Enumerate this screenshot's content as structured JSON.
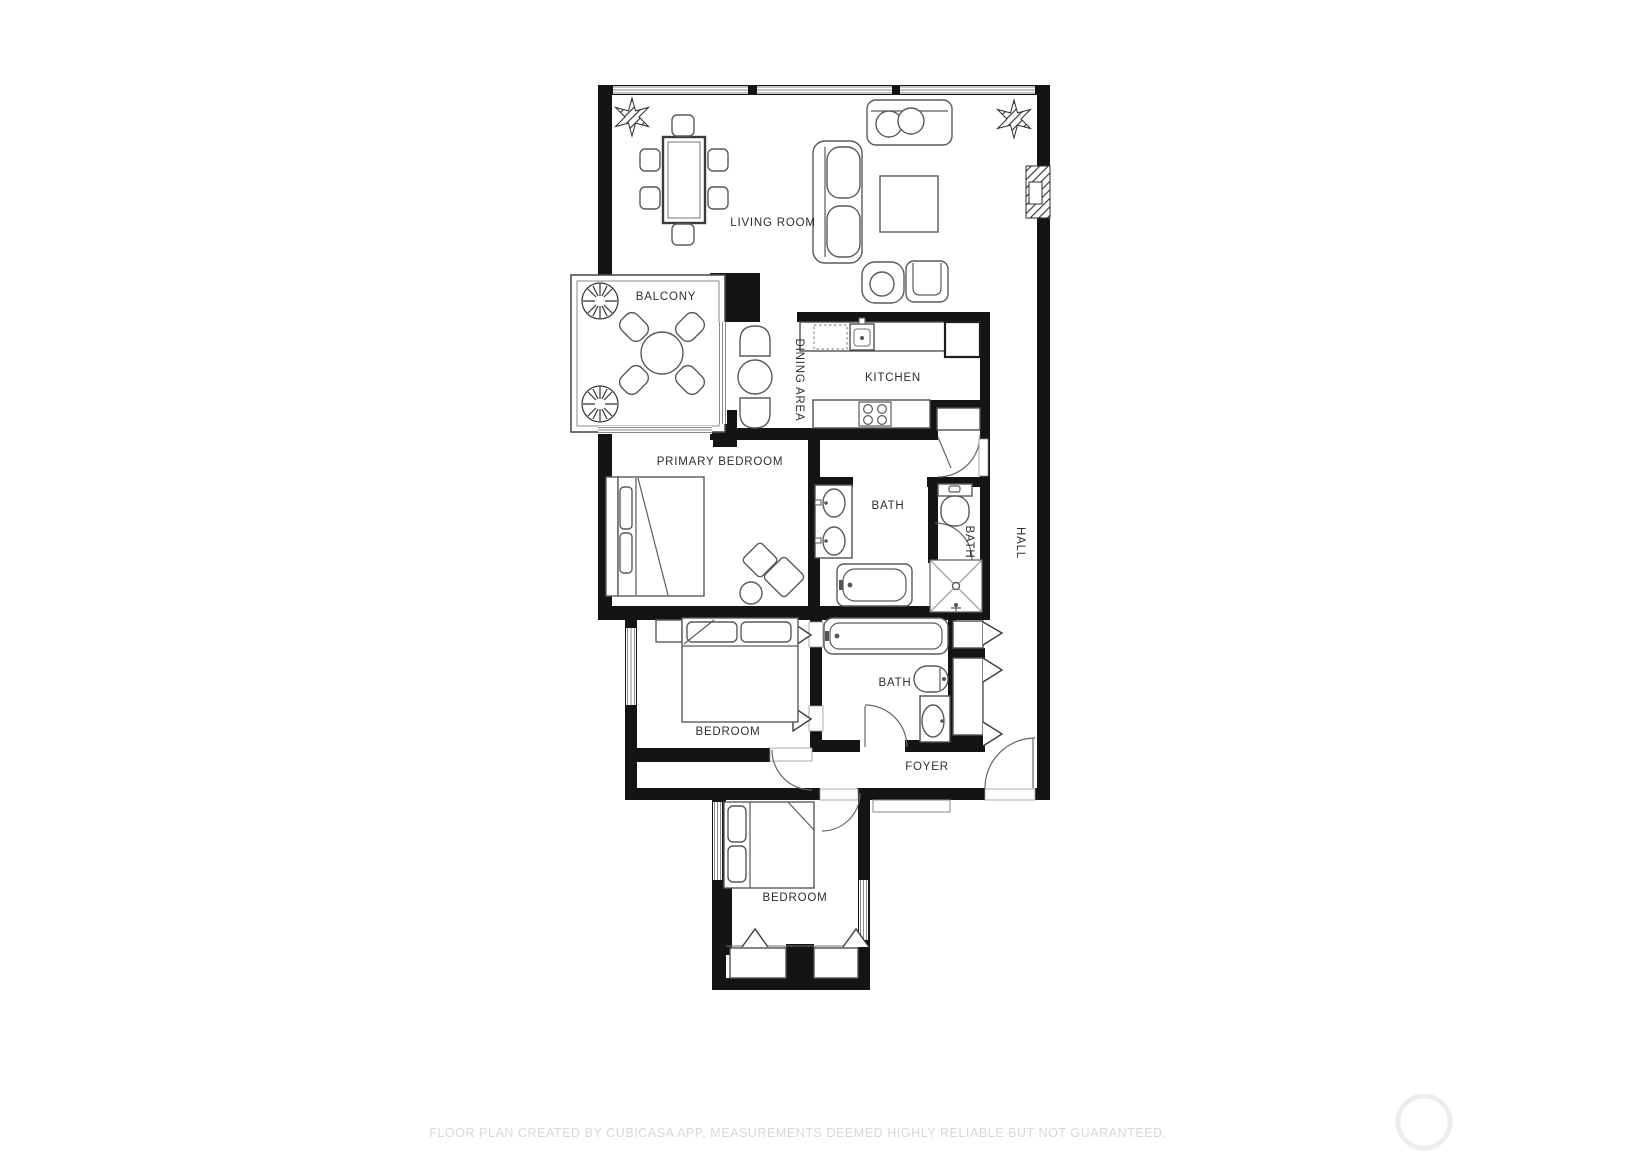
{
  "floor_plan": {
    "rooms": [
      {
        "id": "living-room",
        "label": "LIVING ROOM",
        "orientation": "horizontal"
      },
      {
        "id": "balcony",
        "label": "BALCONY",
        "orientation": "horizontal"
      },
      {
        "id": "dining-area",
        "label": "DINING AREA",
        "orientation": "vertical"
      },
      {
        "id": "kitchen",
        "label": "KITCHEN",
        "orientation": "horizontal"
      },
      {
        "id": "primary-bedroom",
        "label": "PRIMARY BEDROOM",
        "orientation": "horizontal"
      },
      {
        "id": "bath-main",
        "label": "BATH",
        "orientation": "horizontal"
      },
      {
        "id": "bath-shower",
        "label": "BATH",
        "orientation": "vertical"
      },
      {
        "id": "hall",
        "label": "HALL",
        "orientation": "vertical"
      },
      {
        "id": "bedroom-middle",
        "label": "BEDROOM",
        "orientation": "horizontal"
      },
      {
        "id": "bath-guest",
        "label": "BATH",
        "orientation": "horizontal"
      },
      {
        "id": "foyer",
        "label": "FOYER",
        "orientation": "horizontal"
      },
      {
        "id": "bedroom-lower",
        "label": "BEDROOM",
        "orientation": "horizontal"
      }
    ],
    "footer_note": "FLOOR PLAN CREATED BY CUBICASA APP, MEASUREMENTS DEEMED HIGHLY RELIABLE BUT NOT GUARANTEED.",
    "colors": {
      "wall": "#141414",
      "room_label": "#2e2e2e",
      "furniture_stroke": "#5a5a5a",
      "window_stroke": "#8a8a8a",
      "footer_text": "#d8d8d8",
      "watermark": "#ededed",
      "background": "#ffffff"
    }
  }
}
